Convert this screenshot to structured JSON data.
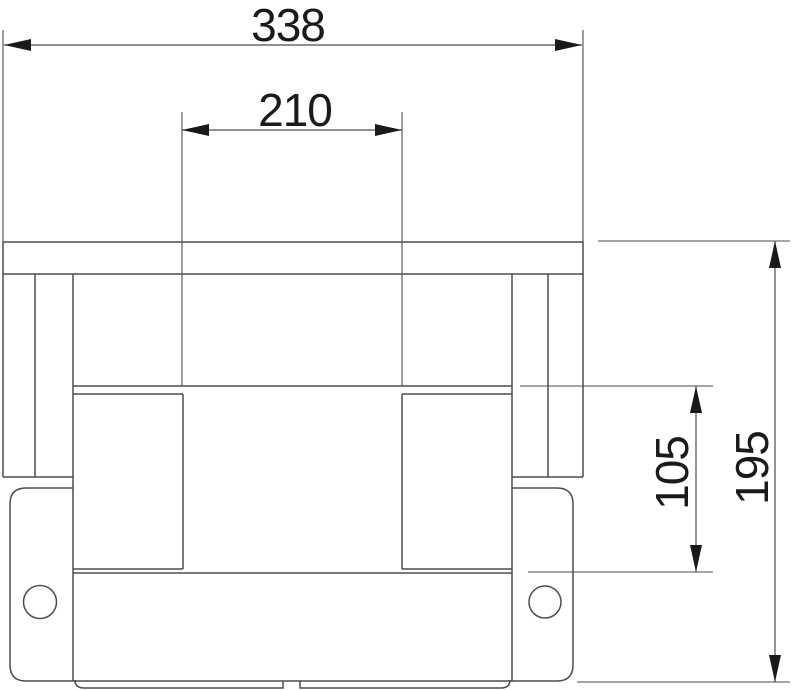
{
  "drawing": {
    "type": "technical-dimension-drawing",
    "background_color": "#ffffff",
    "line_color": "#4d4d4d",
    "text_color": "#1a1a1a",
    "dimensions": {
      "overall_width": {
        "value": "338",
        "orientation": "horizontal"
      },
      "inner_width": {
        "value": "210",
        "orientation": "horizontal"
      },
      "step_height": {
        "value": "105",
        "orientation": "vertical"
      },
      "overall_height": {
        "value": "195",
        "orientation": "vertical"
      }
    }
  }
}
